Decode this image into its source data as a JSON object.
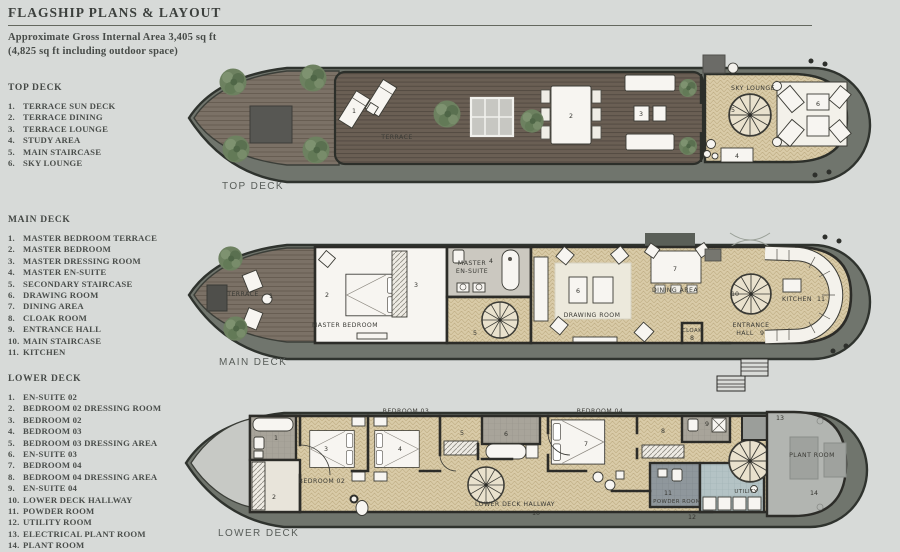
{
  "header": {
    "title": "FLAGSHIP PLANS & LAYOUT",
    "area_line1": "Approximate Gross Internal Area 3,405 sq ft",
    "area_line2": "(4,825 sq ft  including outdoor space)"
  },
  "sections": [
    {
      "heading": "TOP DECK",
      "items": [
        {
          "n": "1.",
          "t": "TERRACE SUN DECK"
        },
        {
          "n": "2.",
          "t": "TERRACE DINING"
        },
        {
          "n": "3.",
          "t": "TERRACE LOUNGE"
        },
        {
          "n": "4.",
          "t": "STUDY AREA"
        },
        {
          "n": "5.",
          "t": "MAIN STAIRCASE"
        },
        {
          "n": "6.",
          "t": "SKY LOUNGE"
        }
      ]
    },
    {
      "heading": "MAIN DECK",
      "items": [
        {
          "n": "1.",
          "t": "MASTER BEDROOM TERRACE"
        },
        {
          "n": "2.",
          "t": "MASTER BEDROOM"
        },
        {
          "n": "3.",
          "t": "MASTER DRESSING ROOM"
        },
        {
          "n": "4.",
          "t": "MASTER EN-SUITE"
        },
        {
          "n": "5.",
          "t": "SECONDARY STAIRCASE"
        },
        {
          "n": "6.",
          "t": "DRAWING ROOM"
        },
        {
          "n": "7.",
          "t": "DINING AREA"
        },
        {
          "n": "8.",
          "t": "CLOAK ROOM"
        },
        {
          "n": "9.",
          "t": "ENTRANCE HALL"
        },
        {
          "n": "10.",
          "t": "MAIN STAIRCASE"
        },
        {
          "n": "11.",
          "t": "KITCHEN"
        }
      ]
    },
    {
      "heading": "LOWER DECK",
      "items": [
        {
          "n": "1.",
          "t": "EN-SUITE 02"
        },
        {
          "n": "2.",
          "t": "BEDROOM 02 DRESSING ROOM"
        },
        {
          "n": "3.",
          "t": "BEDROOM 02"
        },
        {
          "n": "4.",
          "t": "BEDROOM 03"
        },
        {
          "n": "5.",
          "t": "BEDROOM 03 DRESSING AREA"
        },
        {
          "n": "6.",
          "t": "EN-SUITE 03"
        },
        {
          "n": "7.",
          "t": "BEDROOM 04"
        },
        {
          "n": "8.",
          "t": "BEDROOM 04 DRESSING AREA"
        },
        {
          "n": "9.",
          "t": "EN-SUITE 04"
        },
        {
          "n": "10.",
          "t": "LOWER DECK HALLWAY"
        },
        {
          "n": "11.",
          "t": "POWDER ROOM"
        },
        {
          "n": "12.",
          "t": "UTILITY ROOM"
        },
        {
          "n": "13.",
          "t": "ELECTRICAL PLANT ROOM"
        },
        {
          "n": "14.",
          "t": "PLANT ROOM"
        }
      ]
    }
  ],
  "plans": {
    "top": {
      "caption": "TOP DECK",
      "labels": {
        "terrace": "TERRACE",
        "sky_lounge": "SKY LOUNGE"
      },
      "markers": [
        "1",
        "2",
        "3",
        "4",
        "5",
        "6"
      ]
    },
    "main": {
      "caption": "MAIN DECK",
      "labels": {
        "terrace": "TERRACE",
        "master_bedroom": "MASTER BEDROOM",
        "master": "MASTER",
        "en_suite": "EN-SUITE",
        "drawing_room": "DRAWING ROOM",
        "dining_area": "DINING AREA",
        "cloak": "CLOAK",
        "entrance": "ENTRANCE",
        "hall": "HALL",
        "kitchen": "KITCHEN"
      },
      "markers": [
        "1",
        "2",
        "3",
        "4",
        "5",
        "6",
        "7",
        "8",
        "9",
        "10",
        "11"
      ]
    },
    "lower": {
      "caption": "LOWER DECK",
      "labels": {
        "bedroom02": "BEDROOM 02",
        "bedroom03": "BEDROOM 03",
        "bedroom04": "BEDROOM 04",
        "hallway": "LOWER DECK HALLWAY",
        "powder": "POWDER ROOM",
        "utility": "UTILITY",
        "plant": "PLANT ROOM"
      },
      "markers": [
        "1",
        "2",
        "3",
        "4",
        "5",
        "6",
        "7",
        "8",
        "9",
        "10",
        "11",
        "12",
        "13",
        "14"
      ]
    }
  },
  "colors": {
    "background": "#d7dad8",
    "hull_band": "#70756d",
    "hull_outline": "#2f332e",
    "deck_wood": "#6a5f54",
    "bow_wood": "#7b7166",
    "herringbone": "#d9cba8",
    "room_white": "#f7f5f1",
    "tree_green": "#6d8160",
    "text": "#4a4e4b"
  }
}
